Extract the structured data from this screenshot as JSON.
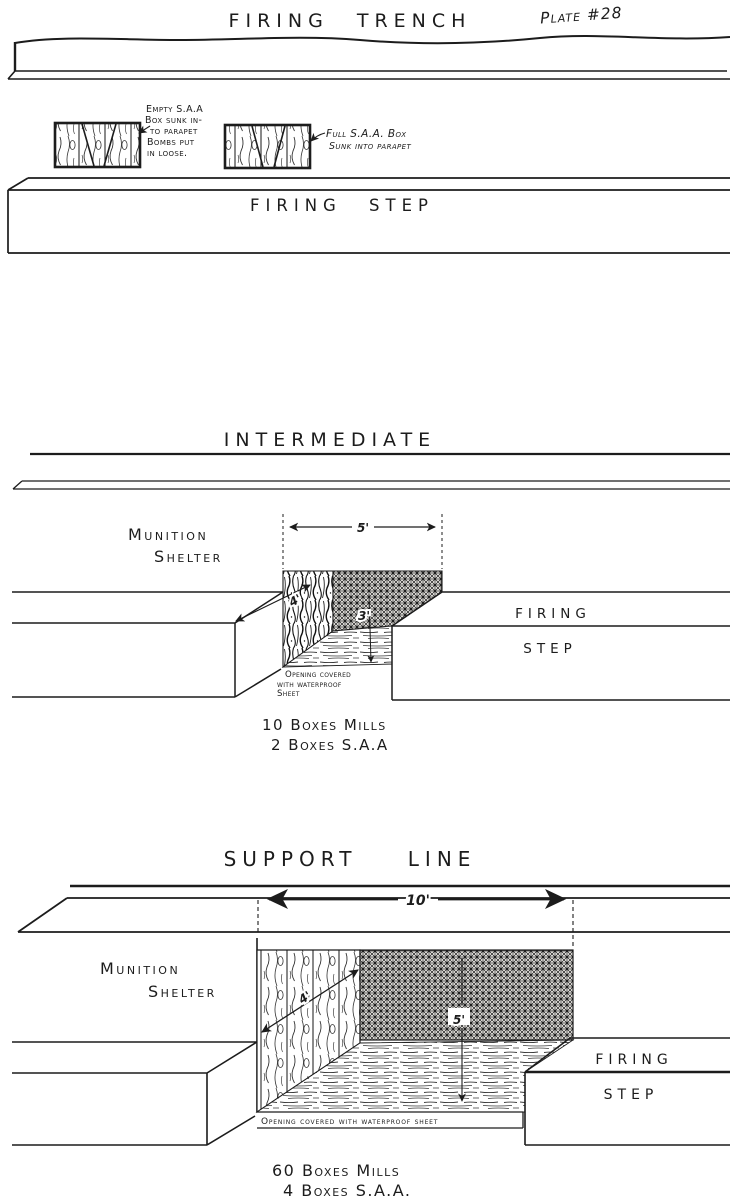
{
  "page": {
    "plate_label": "Plate #28"
  },
  "firing_trench": {
    "title": "FIRING TRENCH",
    "firing_step_label": "FIRING STEP",
    "empty_box_note": {
      "l1": "Empty S.A.A",
      "l2": "Box sunk in-",
      "l3": "to parapet",
      "l4": "Bombs put",
      "l5": "in loose."
    },
    "full_box_note": {
      "l1": "Full S.A.A. Box",
      "l2": "Sunk into parapet"
    }
  },
  "intermediate": {
    "title": "INTERMEDIATE",
    "shelter_label_l1": "Munition",
    "shelter_label_l2": "Shelter",
    "width_dim": "5'",
    "depth_dim": "4'",
    "height_dim": "3'",
    "firing_label": "FIRING",
    "step_label": "STEP",
    "opening_note": {
      "l1": "Opening covered",
      "l2": "with waterproof",
      "l3": "Sheet"
    },
    "stock_l1": "10 Boxes Mills",
    "stock_l2": "2 Boxes S.A.A"
  },
  "support_line": {
    "title": "SUPPORT LINE",
    "shelter_label_l1": "Munition",
    "shelter_label_l2": "Shelter",
    "width_dim": "10'",
    "depth_dim": "4'",
    "height_dim": "5'",
    "firing_label": "FIRING",
    "step_label": "STEP",
    "opening_note": "Opening covered with waterproof sheet",
    "stock_l1": "60 Boxes Mills",
    "stock_l2": "4 Boxes S.A.A."
  },
  "colors": {
    "ink": "#1c1c1c",
    "paper": "#ffffff"
  }
}
